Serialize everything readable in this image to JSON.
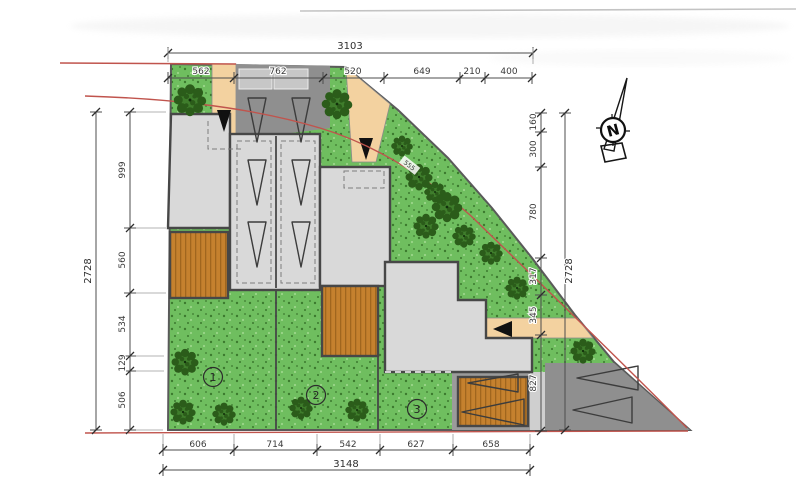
{
  "title": "site-plan-drawing",
  "colors": {
    "grass": "#6fbe5f",
    "grass_dot_dark": "#3c7a2e",
    "grass_dot_light": "#9bd689",
    "building": "#d9d9d9",
    "deck": "#c5812e",
    "deck_stripe": "#a0661e",
    "driveway": "#8f8f8f",
    "driveway_light": "#9b9b9b",
    "path_beige": "#f3d2a0",
    "boundary_red": "#c0544d",
    "outline": "#474747",
    "tree_dark": "#2b5c1a",
    "tree_mid": "#3f7d2c"
  },
  "dims": {
    "top": {
      "overall": "3103",
      "segments": [
        "562",
        "762",
        "520",
        "649",
        "210",
        "400"
      ]
    },
    "left": {
      "overall": "2728",
      "segments": [
        "999",
        "560",
        "534",
        "129",
        "506"
      ]
    },
    "right": {
      "overall": "2728",
      "segments": [
        "160",
        "300",
        "780",
        "317",
        "345",
        "827"
      ]
    },
    "bottom": {
      "overall": "3148",
      "segments": [
        "606",
        "714",
        "542",
        "627",
        "658"
      ]
    }
  },
  "plots": {
    "p1": "1",
    "p2": "2",
    "p3": "3"
  },
  "north_label": "N",
  "slope_label": "555"
}
